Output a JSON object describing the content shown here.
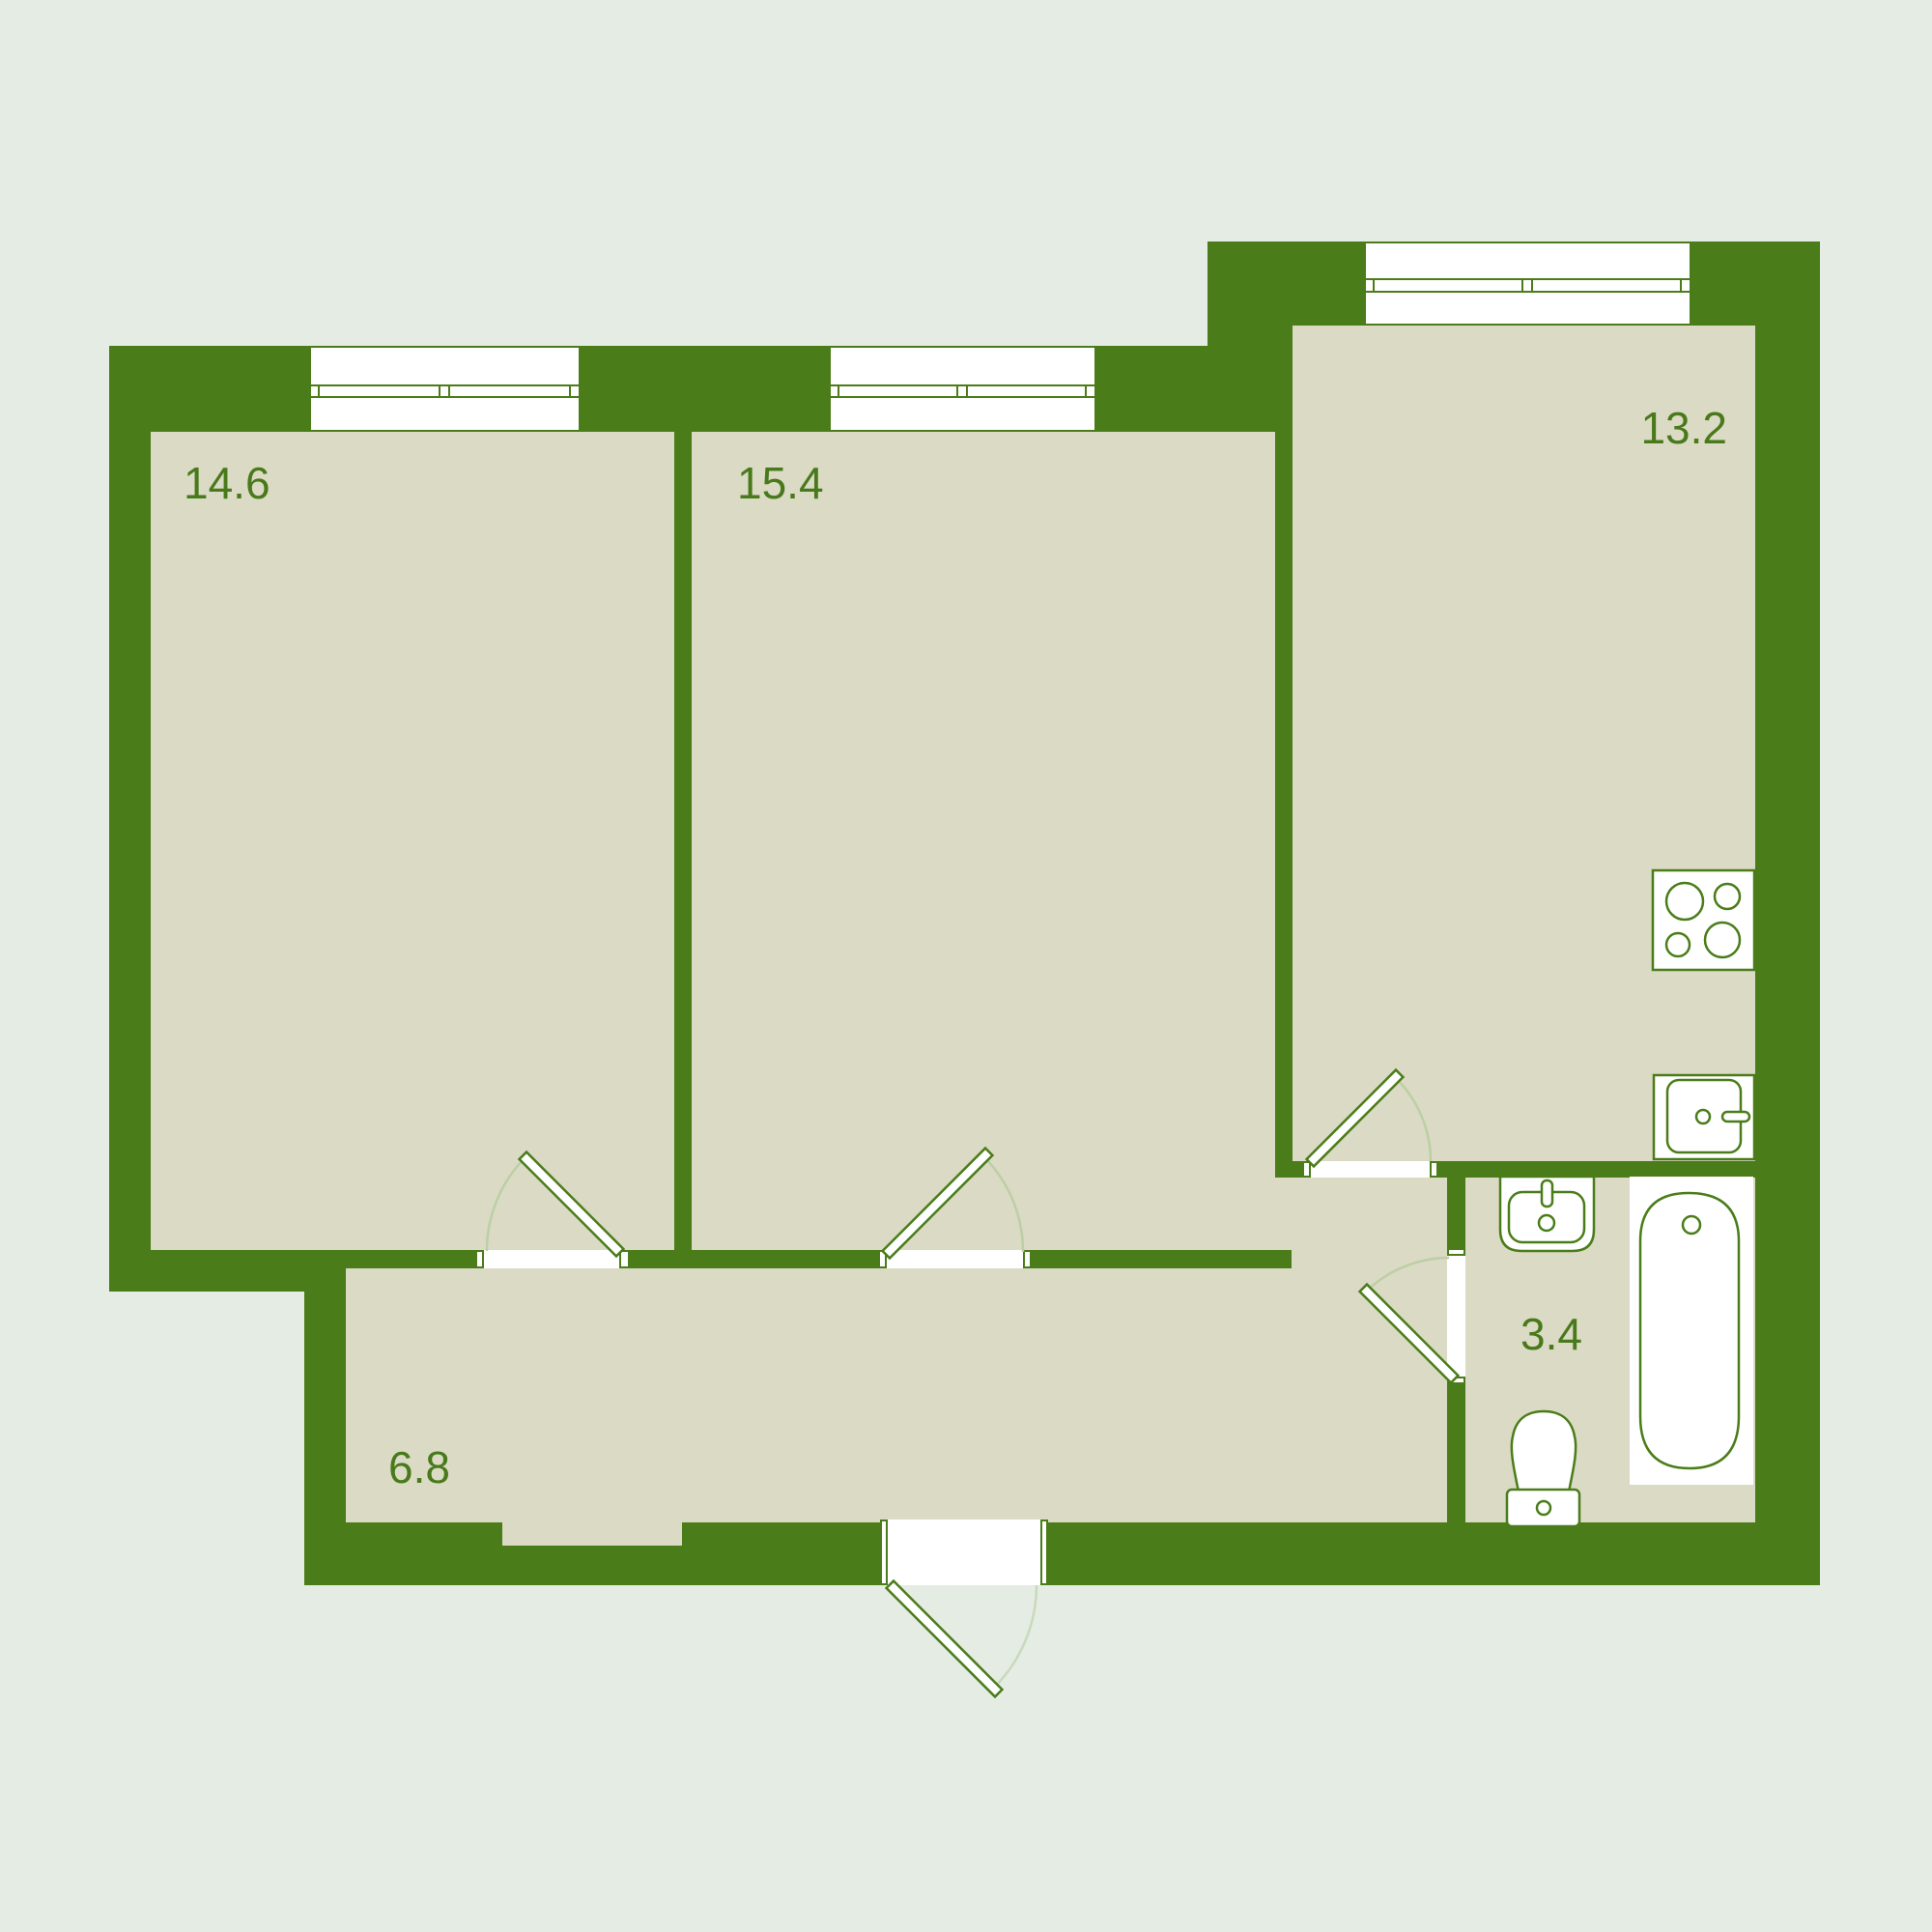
{
  "title": "Apartment floor plan",
  "colors": {
    "wall": "#4a7d19",
    "floor": "#dbdac4",
    "bg": "#e4ece4",
    "arc": "#bccfa5",
    "label": "#48791b",
    "fixture_fill": "#ffffff"
  },
  "rooms": [
    {
      "name": "bedroom-left",
      "area_label": "14.6"
    },
    {
      "name": "bedroom-middle",
      "area_label": "15.4"
    },
    {
      "name": "kitchen",
      "area_label": "13.2"
    },
    {
      "name": "hallway",
      "area_label": "6.8"
    },
    {
      "name": "bathroom",
      "area_label": "3.4"
    }
  ],
  "fixtures": [
    {
      "name": "stove-icon"
    },
    {
      "name": "kitchen-sink-icon"
    },
    {
      "name": "bathroom-sink-icon"
    },
    {
      "name": "toilet-icon"
    },
    {
      "name": "bathtub-icon"
    }
  ]
}
